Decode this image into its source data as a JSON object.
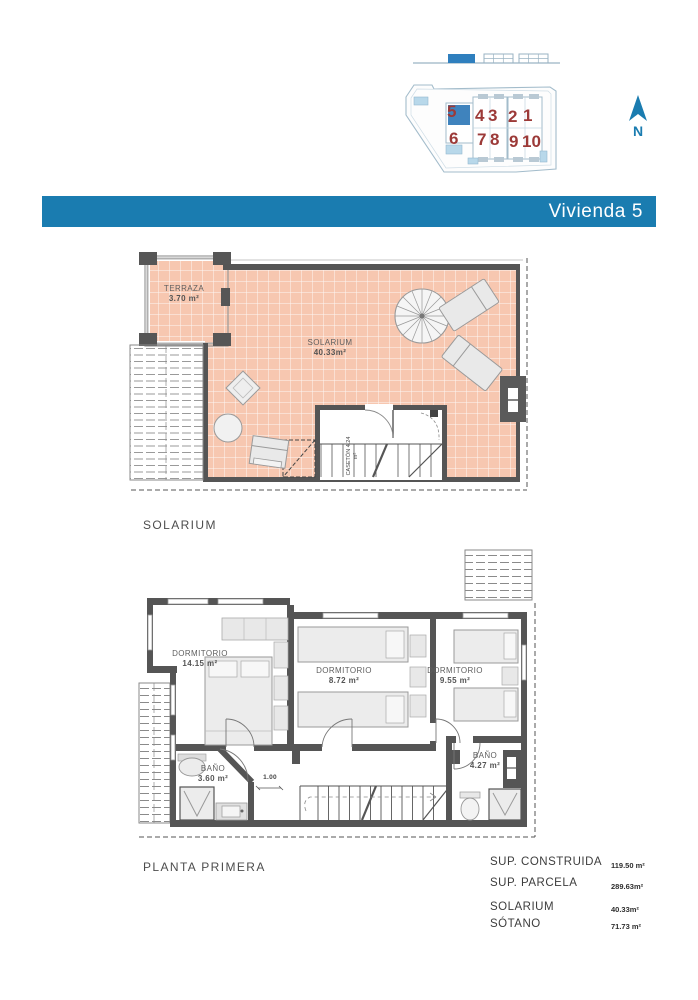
{
  "header": {
    "title": "Vivienda 5"
  },
  "site_plan": {
    "units_top": [
      "5",
      "4",
      "3",
      "2",
      "1"
    ],
    "units_bottom": [
      "6",
      "7",
      "8",
      "9",
      "10"
    ],
    "highlighted_unit": "5",
    "north_label": "N"
  },
  "solarium_plan": {
    "caption": "SOLARIUM",
    "terraza": {
      "name": "TERRAZA",
      "area": "3.70 m²"
    },
    "solarium": {
      "name": "SOLARIUM",
      "area": "40.33m²"
    },
    "caseton": {
      "name": "CASETÓN",
      "area": "4.24 m²"
    }
  },
  "first_floor": {
    "caption": "PLANTA PRIMERA",
    "dormitorio1": {
      "name": "DORMITORIO",
      "area": "14.15 m²"
    },
    "dormitorio2": {
      "name": "DORMITORIO",
      "area": "8.72 m²"
    },
    "dormitorio3": {
      "name": "DORMITORIO",
      "area": "9.55 m²"
    },
    "bano1": {
      "name": "BAÑO",
      "area": "3.60 m²"
    },
    "bano2": {
      "name": "BAÑO",
      "area": "4.27 m²"
    },
    "dim_label": "1.00"
  },
  "summary": {
    "rows": [
      {
        "label": "SUP. CONSTRUIDA",
        "value": "119.50 m²"
      },
      {
        "label": "SUP. PARCELA",
        "value": "289.63m²"
      },
      {
        "label": "SOLARIUM",
        "value": "40.33m²"
      },
      {
        "label": "SÓTANO",
        "value": "71.73 m²"
      }
    ]
  },
  "colors": {
    "header_blue": "#1a7cb0",
    "tile_pink": "#f7c7b0",
    "wall_gray": "#555555",
    "unit_number_red": "#9c3a38",
    "site_line_blue": "#a3bccb",
    "highlight_blue": "#3f83bd",
    "pool_blue": "#b8d8ea"
  }
}
